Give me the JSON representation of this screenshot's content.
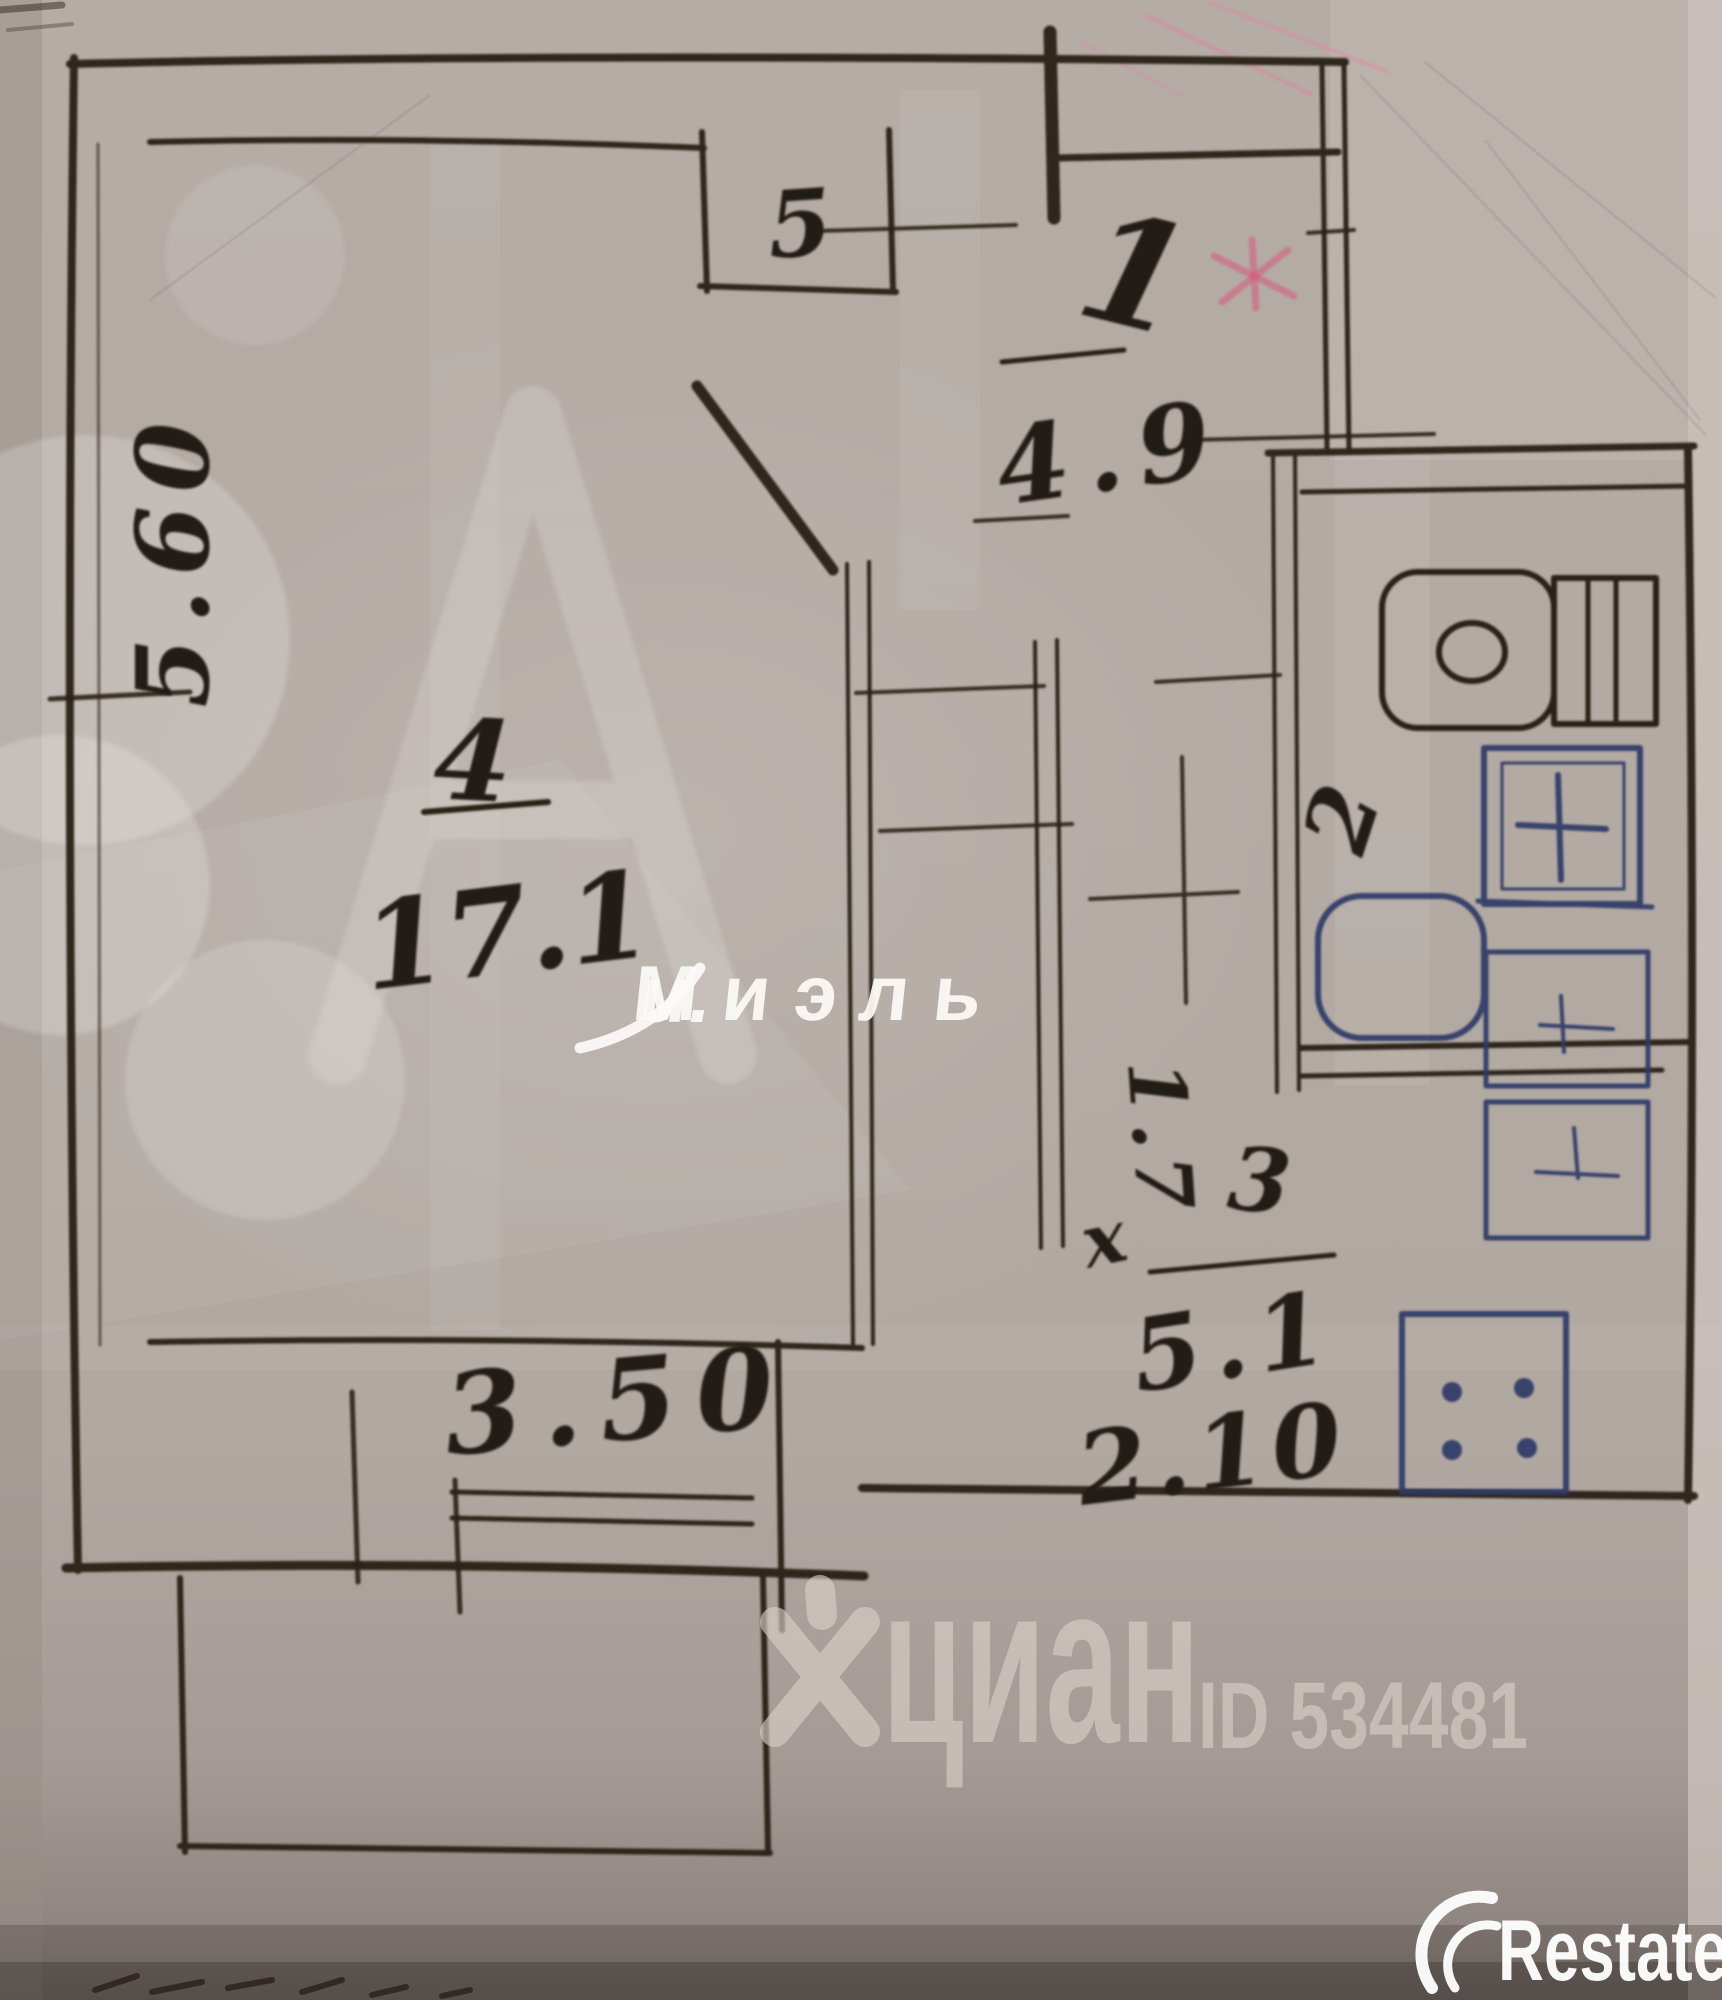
{
  "photo": {
    "type": "hand-drawn apartment floor plan, scanned photo",
    "ink_color": "#2b2118",
    "blue_ink_color": "#2e3a66",
    "paper_color": "#b3a9a3",
    "pink_mark_color": "#d65d86"
  },
  "rooms": {
    "room4": {
      "number": "4",
      "area": "17.1",
      "width": "3.50",
      "depth": "5.60"
    },
    "room1": {
      "number": "1",
      "area": "4.9"
    },
    "room5": {
      "number": "5"
    },
    "room2": {
      "number": "2"
    },
    "room3": {
      "number": "3",
      "area": "5.1",
      "width": "2.10"
    },
    "corridor": {
      "dimension": "1.7",
      "times_sign": "х"
    }
  },
  "watermarks": {
    "miel_script": "и.",
    "miel": "Миэль",
    "cian": "циан",
    "cian_id": "ID 534481",
    "restate": "Restate"
  }
}
